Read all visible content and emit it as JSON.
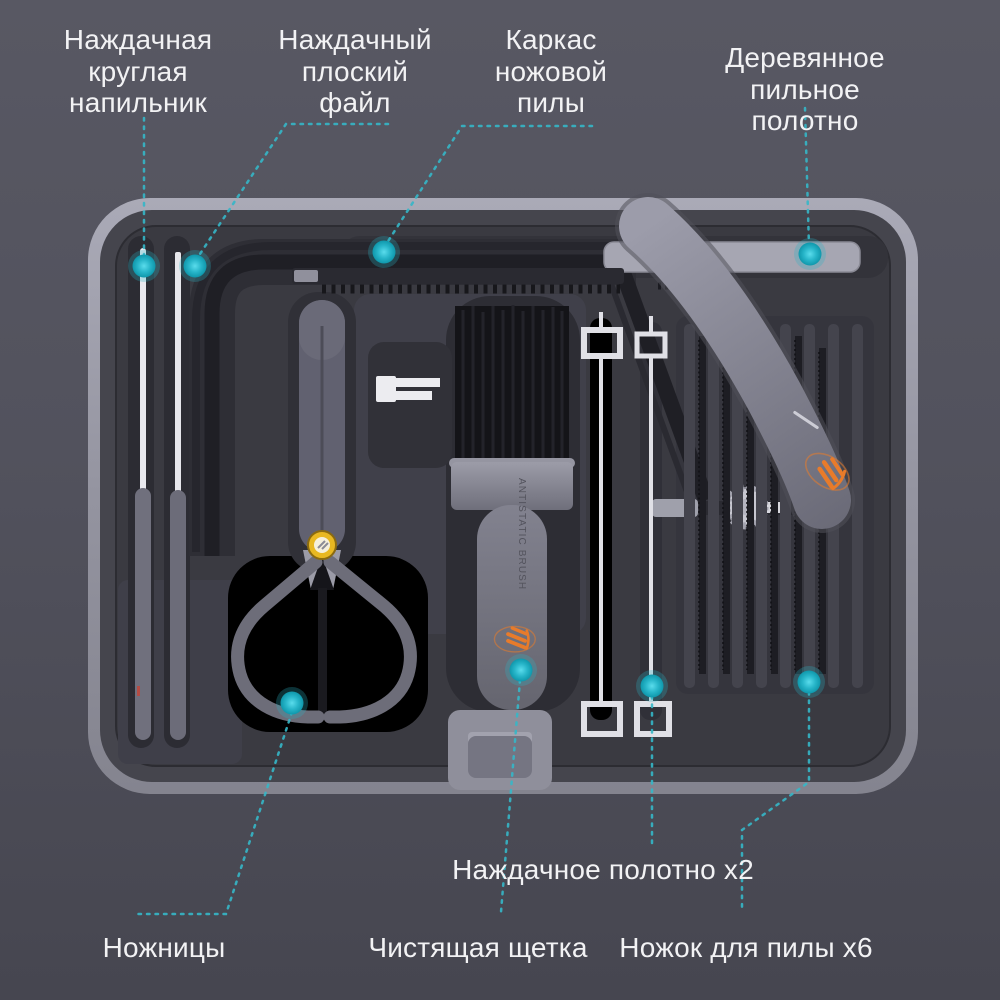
{
  "product": {
    "type": "hand tool kit case with callout annotations",
    "brush_text": "ANTISTATIC BRUSH"
  },
  "labels": [
    {
      "id": "round-file",
      "text": "Наждачная\nкруглая\nнапильник"
    },
    {
      "id": "flat-file",
      "text": "Наждачный\nплоский\nфайл"
    },
    {
      "id": "saw-frame",
      "text": "Каркас\nножовой\nпилы"
    },
    {
      "id": "wood-blade",
      "text": "Деревянное\nпильное полотно"
    },
    {
      "id": "sanding-belt",
      "text": "Наждачное полотно x2"
    },
    {
      "id": "scissors",
      "text": "Ножницы"
    },
    {
      "id": "brush",
      "text": "Чистящая щетка"
    },
    {
      "id": "saw-blades",
      "text": "Ножок для пилы x6"
    }
  ],
  "colors": {
    "accent_teal": "#2fb9cb",
    "logo_orange": "#e87b2a",
    "pivot_yellow": "#eec23a",
    "label_text": "#f2f2f4",
    "background_top": "#585863",
    "background_bottom": "#464650",
    "case_rim": "#a0a0ad",
    "tray": "#3a3a41"
  }
}
